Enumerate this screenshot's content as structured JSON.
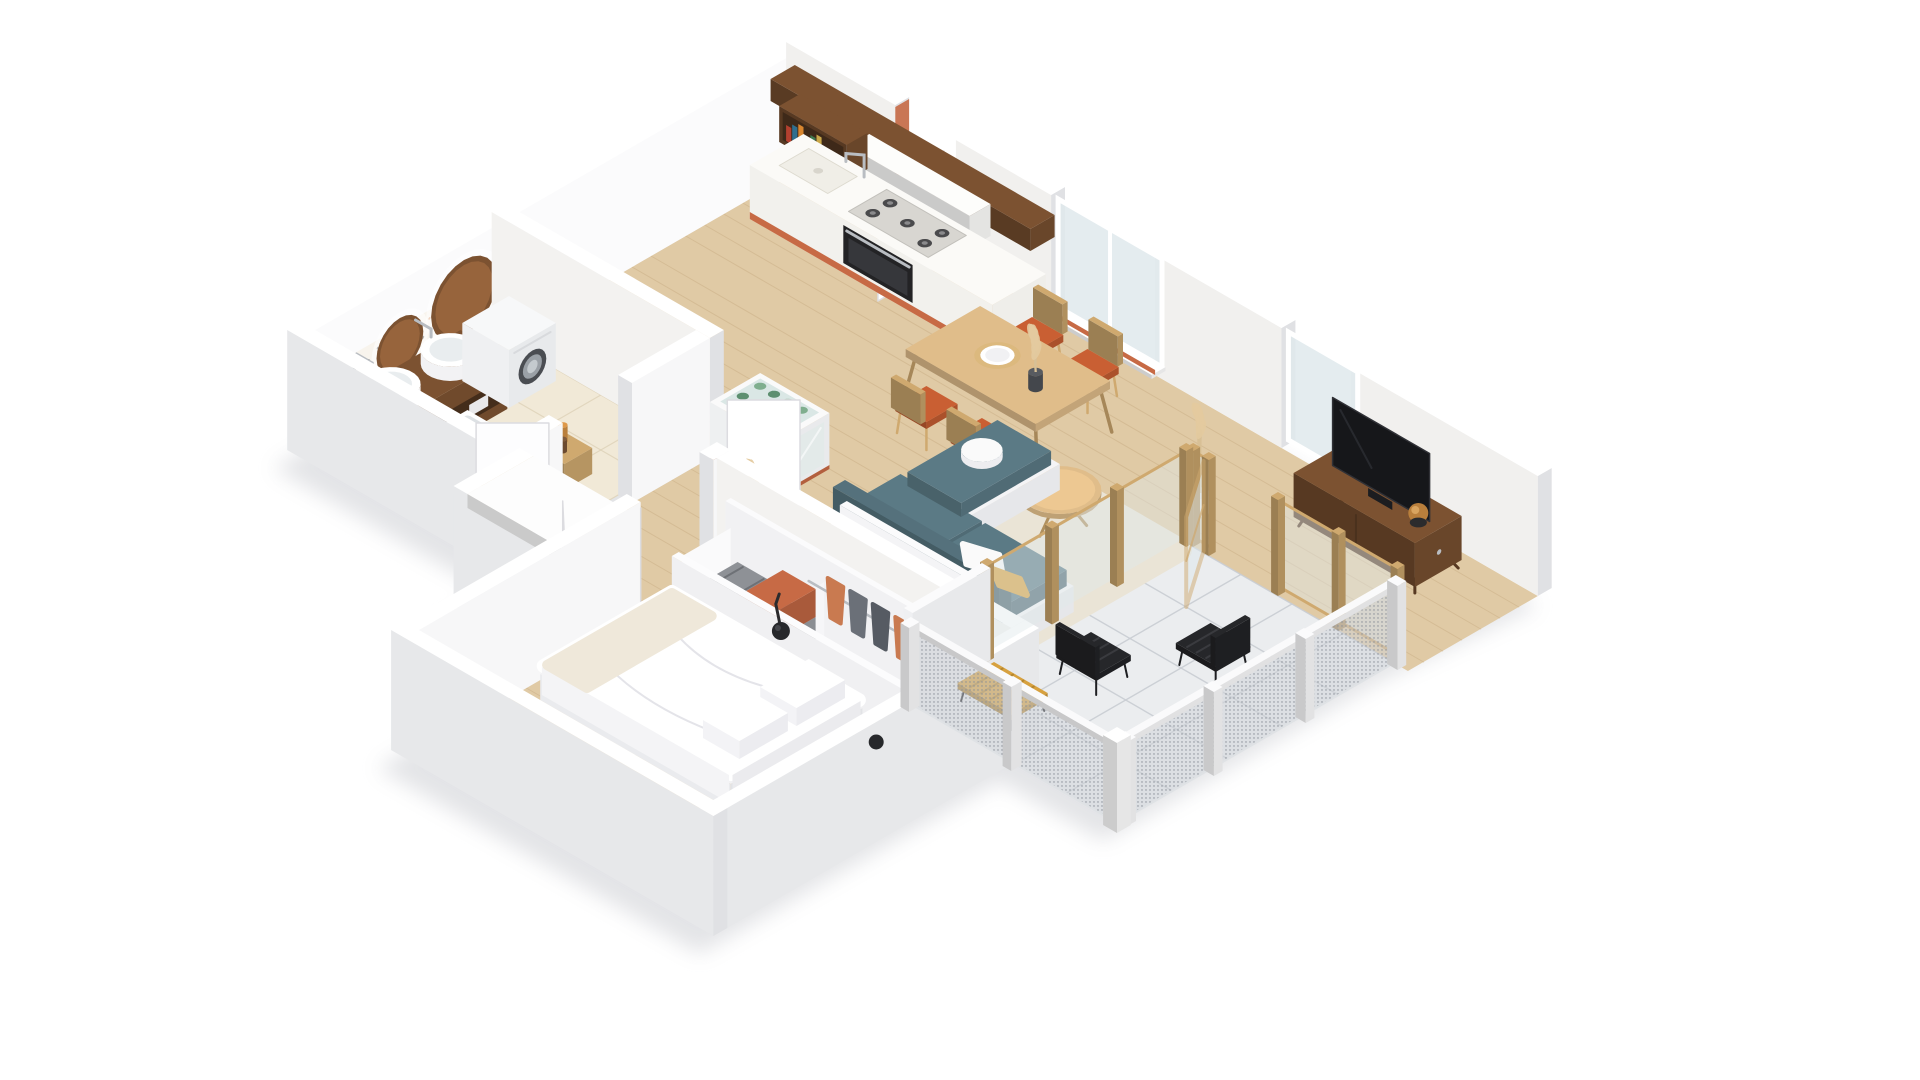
{
  "title": "isometric-apartment-3d-floor-plan",
  "palette": {
    "background": "#ffffff",
    "shadow": "#c2c4ca",
    "wall_top": "#ffffff",
    "wall_inner_ne": "#f1f0ee",
    "wall_inner_nw": "#fbfbfc",
    "wall_outer": "#e7e8ea",
    "wall_cap": "#e0e1e4",
    "floor_wood": "#e0caa5",
    "floor_wood_line": "#c9ae85",
    "floor_tile": "#f1e9d7",
    "floor_tile_line": "#ded2b8",
    "balcony_tile": "#ebedef",
    "balcony_tile_line": "#c9cdd3",
    "walnut": "#7c5231",
    "oak": "#cfa96f",
    "oak_light": "#e0bd8a",
    "terracotta": "#c76a45",
    "chair_orange": "#c95f33",
    "sofa_teal": "#5b7a85",
    "mustard": "#d7a13f",
    "rug": "#eae4d6",
    "steel": "#b9bdc2",
    "glass": "#dfe9ec",
    "black_obj": "#26272a",
    "plant": "#d8c096",
    "amber": "#b97f3c",
    "book_colors": [
      "#b4402f",
      "#2f6f8f",
      "#d9862f",
      "#e8e4da",
      "#3f7a4f",
      "#caa84a"
    ],
    "terrazzo_colors": [
      "#d98f5f",
      "#3a7f8c",
      "#444444",
      "#e0b84f",
      "#c76a45"
    ],
    "clothes_colors": [
      "#6b7078",
      "#9aa0a8",
      "#c97a50",
      "#565b63",
      "#8d9298"
    ],
    "bottle_colors": [
      "#7fae8e",
      "#5d8f70",
      "#a8c6b2"
    ]
  },
  "scene": {
    "type": "3d-isometric-apartment-render",
    "rooms": [
      {
        "id": "kitchen",
        "items": [
          "wood-beam-shelf",
          "upper-cabinets",
          "open-shelf-books",
          "counter",
          "kitchen-sink",
          "faucet",
          "gas-hob",
          "oven",
          "terracotta-toe-kick",
          "minibar-cabinet"
        ]
      },
      {
        "id": "bathroom",
        "items": [
          "terrazzo-wall",
          "round-mirrors",
          "walnut-vanity",
          "vessel-sinks",
          "washing-machine",
          "bathtub",
          "toilet",
          "stool-with-bottles"
        ]
      },
      {
        "id": "dining",
        "items": [
          "oak-table",
          "orange-cushion-chairs",
          "plate-with-placemat",
          "vase-with-pampas"
        ]
      },
      {
        "id": "living",
        "items": [
          "rug",
          "coffee-table",
          "corner-sofa",
          "teal-cushions",
          "mustard-pillow",
          "storage-wall-clothes",
          "towel-rolls",
          "pampas-plant",
          "tv-console",
          "tv",
          "globe-lamp"
        ]
      },
      {
        "id": "hall",
        "items": [
          "entry-niche-wood",
          "doormat",
          "door-leaves"
        ]
      },
      {
        "id": "bedroom",
        "items": [
          "bed",
          "pillows",
          "throw-blanket",
          "wardrobe",
          "suitcase",
          "orange-storage-box",
          "hanging-clothes",
          "wall-arm-lamp"
        ]
      },
      {
        "id": "balcony",
        "items": [
          "tile-floor",
          "wood-glass-wall",
          "open-wood-door",
          "mesh-railing",
          "black-slat-chairs",
          "yellow-slat-bench"
        ]
      }
    ]
  }
}
